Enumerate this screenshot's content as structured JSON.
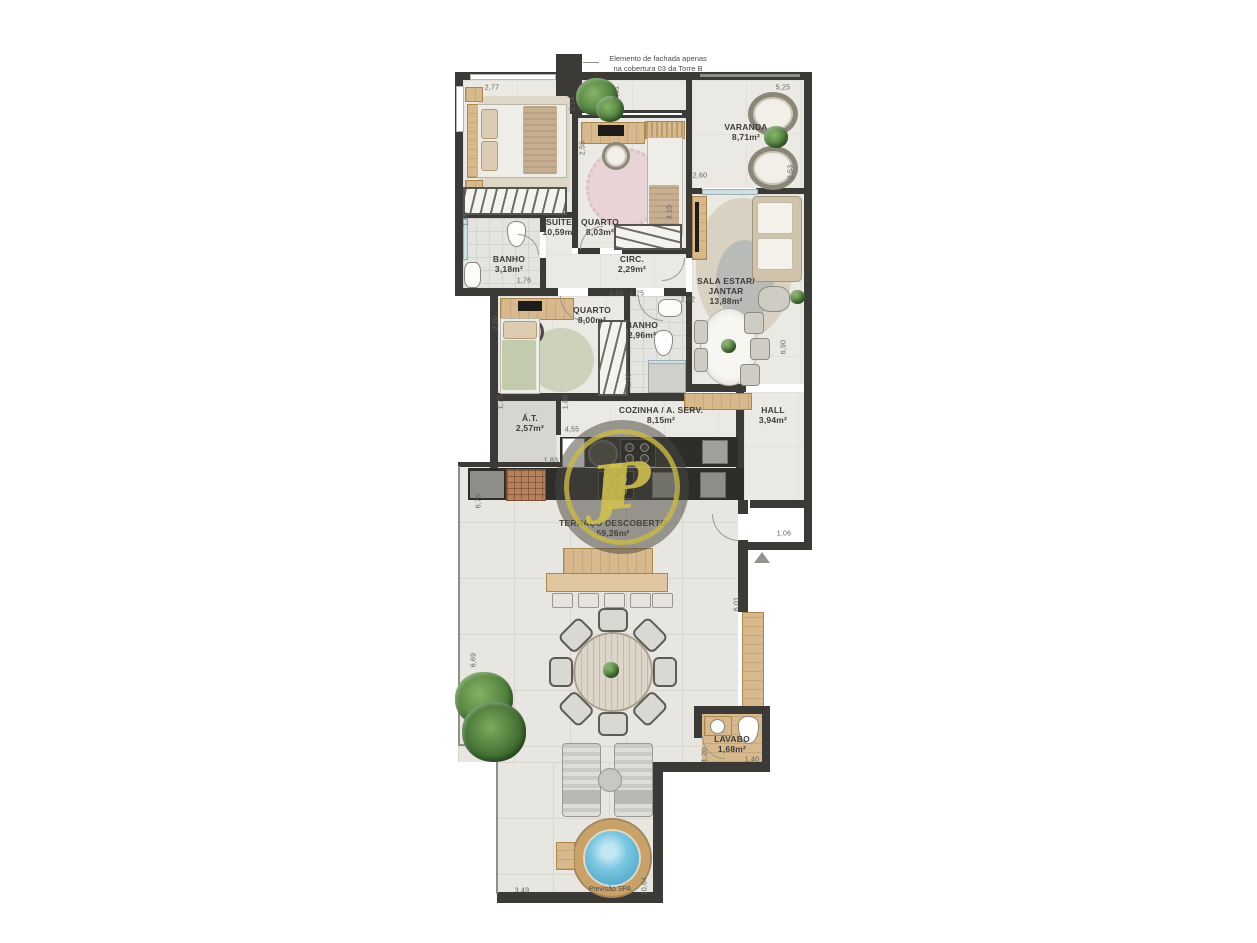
{
  "annotation": {
    "lines": [
      "Elemento de fachada apenas",
      "na cobertura 03 da Torre B"
    ]
  },
  "watermark": {
    "monogram": "JP"
  },
  "rooms": [
    {
      "id": "suite",
      "lines": [
        "SUÍTE"
      ],
      "area": "10,59m²",
      "x": 559,
      "y": 217
    },
    {
      "id": "quarto-1",
      "lines": [
        "QUARTO"
      ],
      "area": "8,03m²",
      "x": 600,
      "y": 217
    },
    {
      "id": "varanda",
      "lines": [
        "VARANDA"
      ],
      "area": "8,71m²",
      "x": 746,
      "y": 122
    },
    {
      "id": "banho-suite",
      "lines": [
        "BANHO"
      ],
      "area": "3,18m²",
      "x": 509,
      "y": 254
    },
    {
      "id": "circ",
      "lines": [
        "CIRC."
      ],
      "area": "2,29m²",
      "x": 632,
      "y": 254
    },
    {
      "id": "sala-estar-jantar",
      "lines": [
        "SALA ESTAR/",
        "JANTAR"
      ],
      "area": "13,88m²",
      "x": 726,
      "y": 276
    },
    {
      "id": "quarto-2",
      "lines": [
        "QUARTO"
      ],
      "area": "8,00m²",
      "x": 592,
      "y": 305
    },
    {
      "id": "banho-2",
      "lines": [
        "BANHO"
      ],
      "area": "2,96m²",
      "x": 642,
      "y": 320
    },
    {
      "id": "area-tecnica",
      "lines": [
        "Á.T."
      ],
      "area": "2,57m²",
      "x": 530,
      "y": 413
    },
    {
      "id": "cozinha",
      "lines": [
        "COZINHA / A. SERV."
      ],
      "area": "8,15m²",
      "x": 661,
      "y": 405
    },
    {
      "id": "hall",
      "lines": [
        "HALL"
      ],
      "area": "3,94m²",
      "x": 773,
      "y": 405
    },
    {
      "id": "terraco",
      "lines": [
        "TERRAÇO DESCOBERTO"
      ],
      "area": "59,26m²",
      "x": 613,
      "y": 518
    },
    {
      "id": "lavabo",
      "lines": [
        "LAVABO"
      ],
      "area": "1,68m²",
      "x": 732,
      "y": 734
    }
  ],
  "spa": {
    "label": "Previsão SPA"
  },
  "dimensions": [
    {
      "v": "2,77",
      "x": 492,
      "y": 88,
      "r": 0
    },
    {
      "v": "5,14",
      "x": 573,
      "y": 104,
      "r": 1
    },
    {
      "v": "0,81",
      "x": 617,
      "y": 93,
      "r": 1
    },
    {
      "v": "5,25",
      "x": 783,
      "y": 88,
      "r": 0
    },
    {
      "v": "2,55",
      "x": 583,
      "y": 148,
      "r": 1
    },
    {
      "v": "2,60",
      "x": 700,
      "y": 176,
      "r": 0
    },
    {
      "v": "2,53",
      "x": 791,
      "y": 172,
      "r": 1
    },
    {
      "v": "1,80",
      "x": 466,
      "y": 219,
      "r": 1
    },
    {
      "v": "3,15",
      "x": 670,
      "y": 212,
      "r": 1
    },
    {
      "v": "1,76",
      "x": 524,
      "y": 281,
      "r": 0
    },
    {
      "v": "2,50",
      "x": 496,
      "y": 323,
      "r": 1
    },
    {
      "v": "3,20",
      "x": 616,
      "y": 294,
      "r": 0
    },
    {
      "v": "1,25",
      "x": 637,
      "y": 294,
      "r": 0
    },
    {
      "v": "2,82",
      "x": 688,
      "y": 300,
      "r": 0
    },
    {
      "v": "6,90",
      "x": 784,
      "y": 347,
      "r": 1
    },
    {
      "v": "1,75",
      "x": 501,
      "y": 402,
      "r": 1
    },
    {
      "v": "1,80",
      "x": 566,
      "y": 402,
      "r": 1
    },
    {
      "v": "4,55",
      "x": 572,
      "y": 430,
      "r": 0
    },
    {
      "v": "2,60",
      "x": 629,
      "y": 380,
      "r": 1
    },
    {
      "v": "1,83",
      "x": 551,
      "y": 461,
      "r": 0
    },
    {
      "v": "6,79",
      "x": 479,
      "y": 501,
      "r": 1
    },
    {
      "v": "1,06",
      "x": 784,
      "y": 534,
      "r": 0
    },
    {
      "v": "6,01",
      "x": 737,
      "y": 604,
      "r": 1
    },
    {
      "v": "6,69",
      "x": 474,
      "y": 660,
      "r": 1
    },
    {
      "v": "1,20",
      "x": 705,
      "y": 755,
      "r": 1
    },
    {
      "v": "1,40",
      "x": 752,
      "y": 760,
      "r": 0
    },
    {
      "v": "3,49",
      "x": 522,
      "y": 891,
      "r": 0
    },
    {
      "v": "10,64",
      "x": 645,
      "y": 886,
      "r": 1
    }
  ]
}
